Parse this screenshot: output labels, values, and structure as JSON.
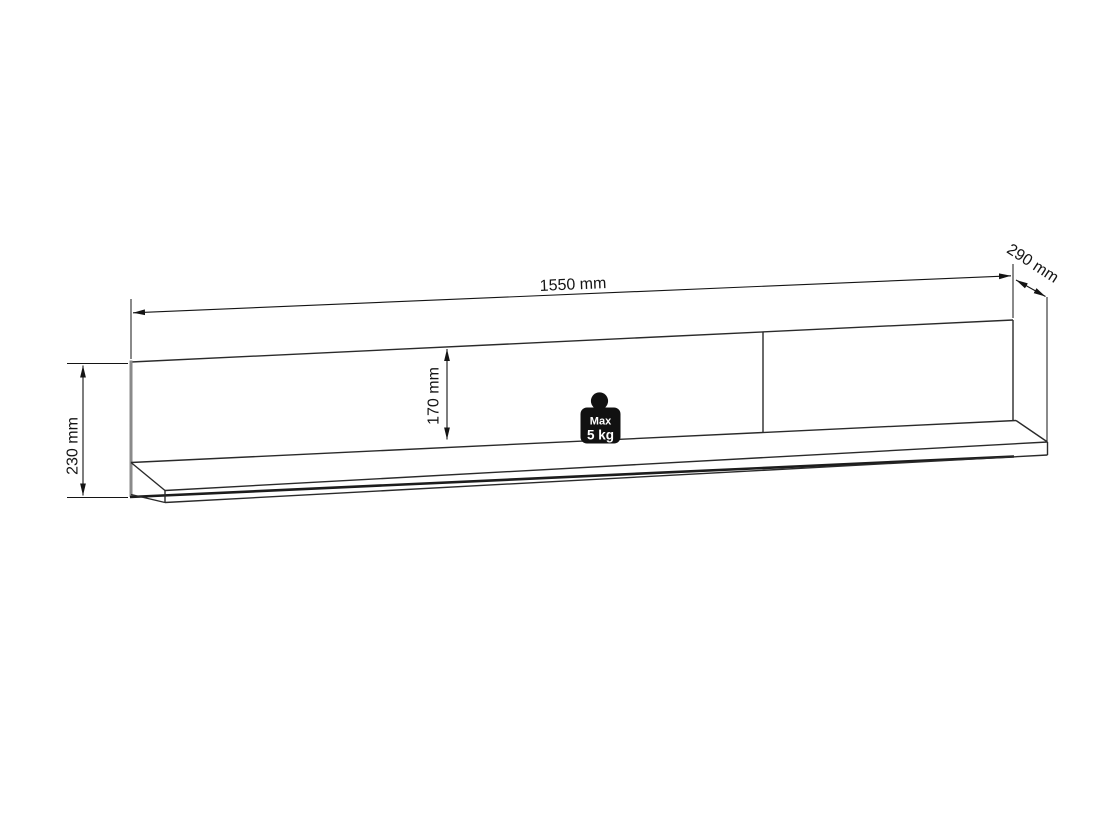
{
  "figure": {
    "type": "furniture-dimension-drawing",
    "subject": "wall shelf",
    "background_color": "#ffffff",
    "line_color": "#2a2a2a",
    "dimension_text_color": "#141414",
    "panel_edge_gray": "#8a8a8a",
    "dimensions": {
      "width": {
        "label": "1550 mm",
        "value_mm": 1550
      },
      "depth": {
        "label": "290 mm",
        "value_mm": 290
      },
      "height": {
        "label": "230 mm",
        "value_mm": 230
      },
      "inner_height": {
        "label": "170 mm",
        "value_mm": 170
      }
    },
    "max_load_badge": {
      "line1": "Max",
      "line2": "5 kg",
      "bg_color": "#111111",
      "text_color": "#ffffff"
    }
  }
}
